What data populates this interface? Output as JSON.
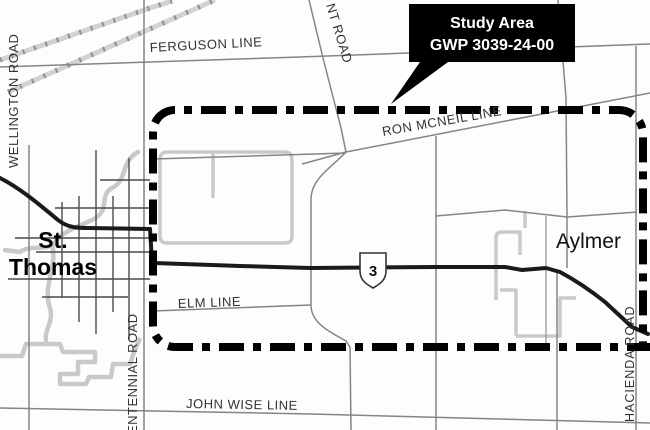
{
  "map": {
    "callout": {
      "line1": "Study Area",
      "line2": "GWP 3039-24-00"
    },
    "labels": {
      "wellington_road": "WELLINGTON ROAD",
      "ferguson_line": "FERGUSON LINE",
      "belmont_road_partial": "NT ROAD",
      "ron_mcneil_line": "RON MCNEIL LINE",
      "st_thomas_line1": "St.",
      "st_thomas_line2": "Thomas",
      "aylmer": "Aylmer",
      "elm_line": "ELM LINE",
      "centennial_road_partial": "ENTENNIAL ROAD",
      "john_wise_line": "JOHN WISE LINE",
      "hacienda_road": "HACIENDA ROAD",
      "highway_shield": "3"
    },
    "colors": {
      "boundary": "#000000",
      "highway": "#1a1a1a",
      "rural_road": "#858585",
      "city_street": "#4a4a4a",
      "light_feature": "#c9c9c9",
      "callout_bg": "#000000",
      "callout_text": "#ffffff",
      "label_text": "#333333"
    }
  }
}
